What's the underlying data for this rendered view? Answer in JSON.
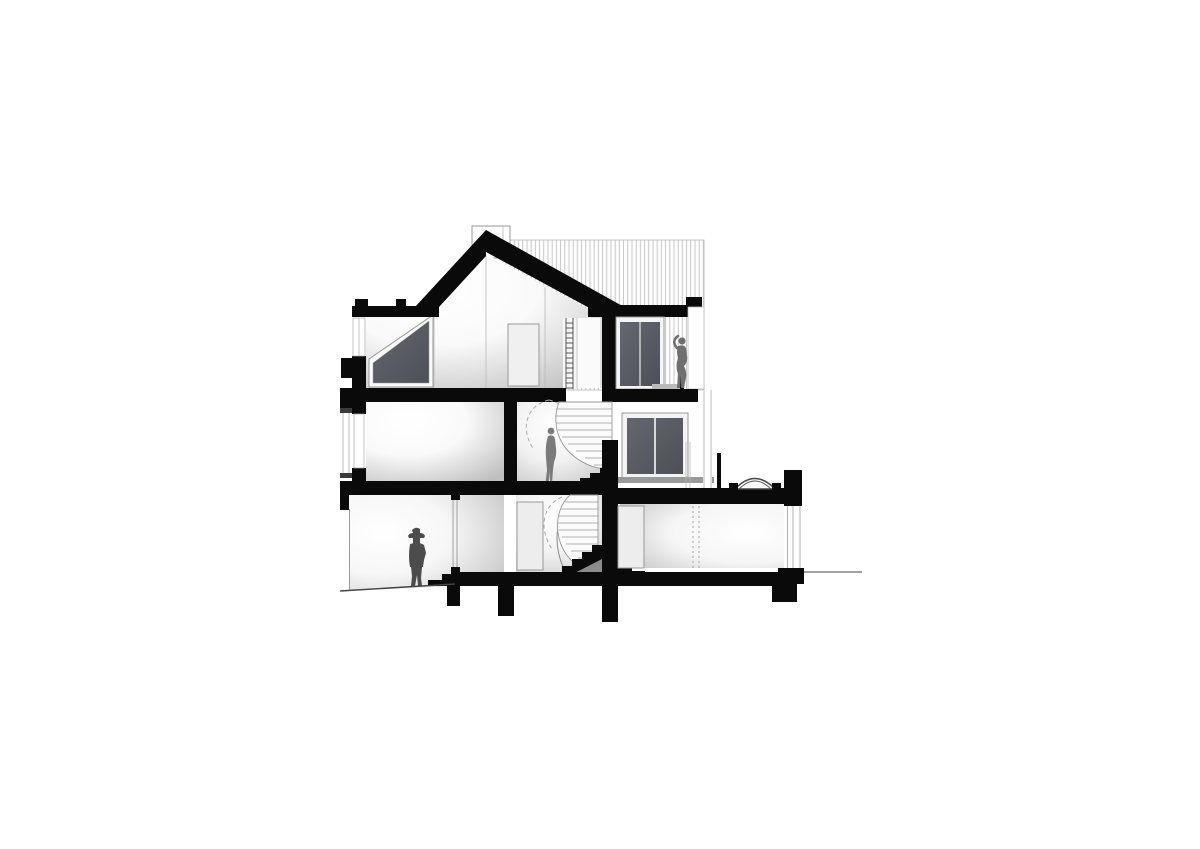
{
  "scene": {
    "type": "architectural-section-drawing",
    "description": "Black-and-white cross-section of a three-storey gabled house with a winding central staircase, roof terrace and a single-storey rear wing",
    "storeys": [
      "attic under gabled roof with sloped window and ladder",
      "middle floor beside winding stair",
      "lower ground floor with entry steps",
      "single-storey rear wing with domed rooflight"
    ],
    "figures": [
      {
        "id": "man-with-hat",
        "location": "lower level, standing on sloping ground at left"
      },
      {
        "id": "woman-at-stair",
        "location": "middle floor, beside the winding stair"
      },
      {
        "id": "woman-on-balcony",
        "location": "upper terrace beside sliding glass door, arm raised"
      }
    ],
    "features": [
      "chimney",
      "gabled black roof",
      "vertical-hatch background wall",
      "sloped trapezoid attic window",
      "ladder",
      "winding stair with dashed handrail arcs",
      "sliding glass door",
      "balcony slab with railing post",
      "two-panel window",
      "domed rooflight",
      "parapet",
      "foundation piers",
      "entry steps",
      "ground lines"
    ]
  },
  "colors": {
    "background": "#ffffff",
    "poche_black": "#0a0a0a",
    "glazing_dark": "#565a60",
    "glazing_frame": "#f4f4f4",
    "figure_gray": "#6f6f6f",
    "figure_mid": "#7b7b7b",
    "figure_dark": "#4c4c4c",
    "hatch_line": "#b5b5b5",
    "outline_gray": "#9a9a9a",
    "shadow_gray": "#8c8c8c",
    "sill_gray": "#999999",
    "ground_line": "#444444"
  }
}
